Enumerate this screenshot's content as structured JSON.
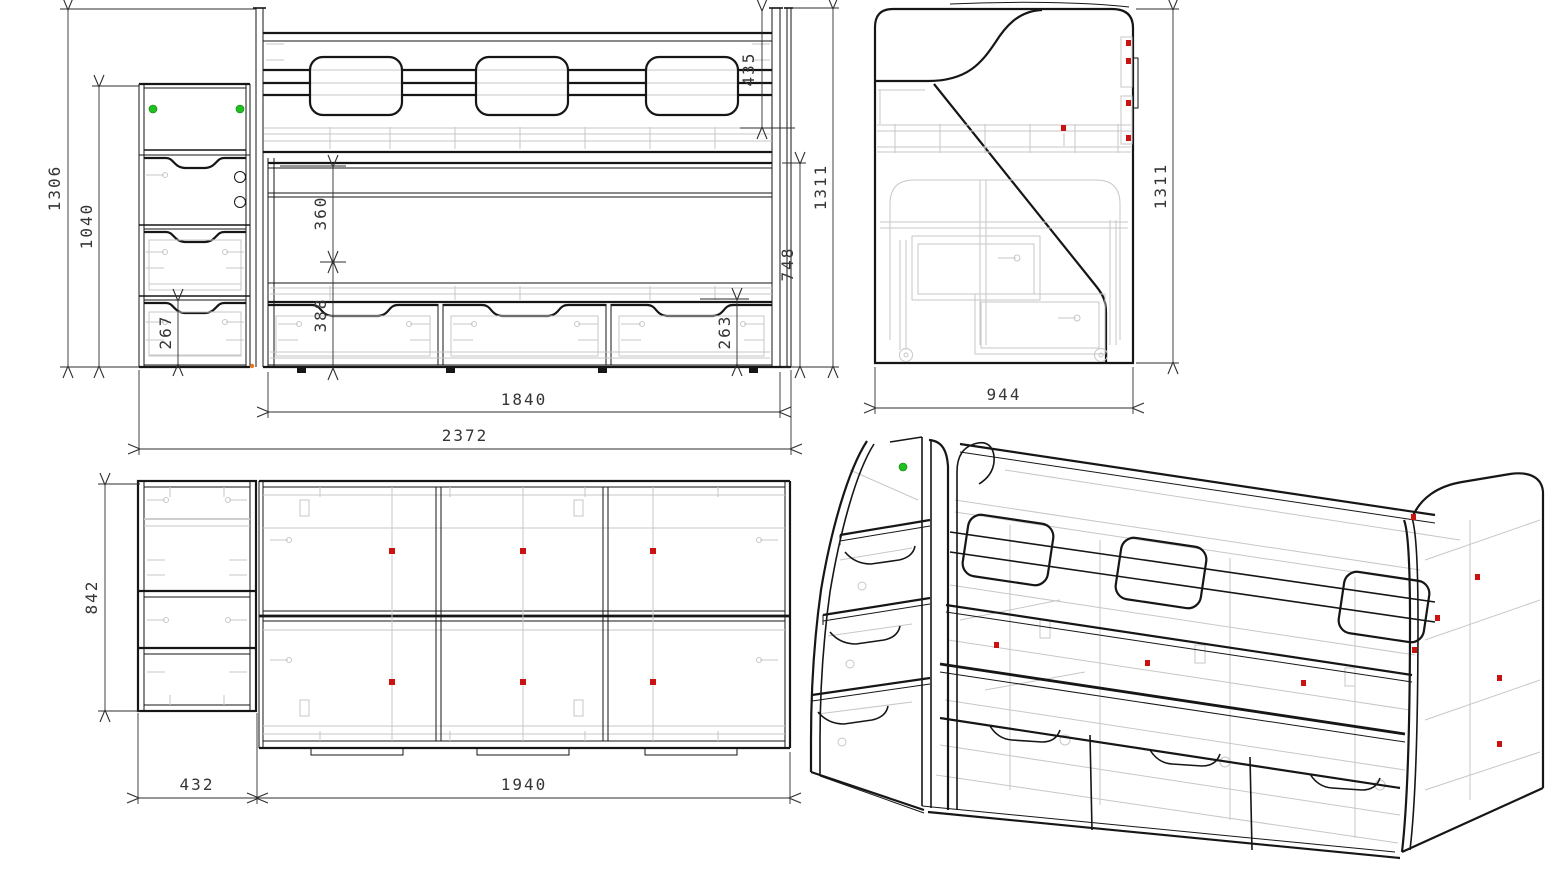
{
  "drawing": {
    "type": "furniture-technical-drawing",
    "subject": "loft bed with staircase drawers",
    "views": {
      "front": "front-view",
      "side": "side-view",
      "plan": "plan-view",
      "iso": "isometric-view"
    },
    "dims": {
      "front_overall_height": "1306",
      "front_stairs_height": "1040",
      "front_stairs_drawer_height": "267",
      "front_guard_rail_height": "435",
      "front_rail_gap": "360",
      "front_drawer_section": "388",
      "front_drawer_front": "263",
      "front_lower_height": "748",
      "front_bed_height": "1311",
      "front_bed_length": "1840",
      "front_overall_length": "2372",
      "side_height": "1311",
      "side_depth": "944",
      "plan_depth": "842",
      "plan_stairs_width": "432",
      "plan_bed_length": "1940"
    },
    "colors": {
      "line": "#161616",
      "hidden_detail": "#c7c7c7",
      "dimension": "#2e2e2e",
      "marker_red": "#cc1111",
      "marker_green": "#1ec11e",
      "marker_orange": "#e07820"
    }
  }
}
